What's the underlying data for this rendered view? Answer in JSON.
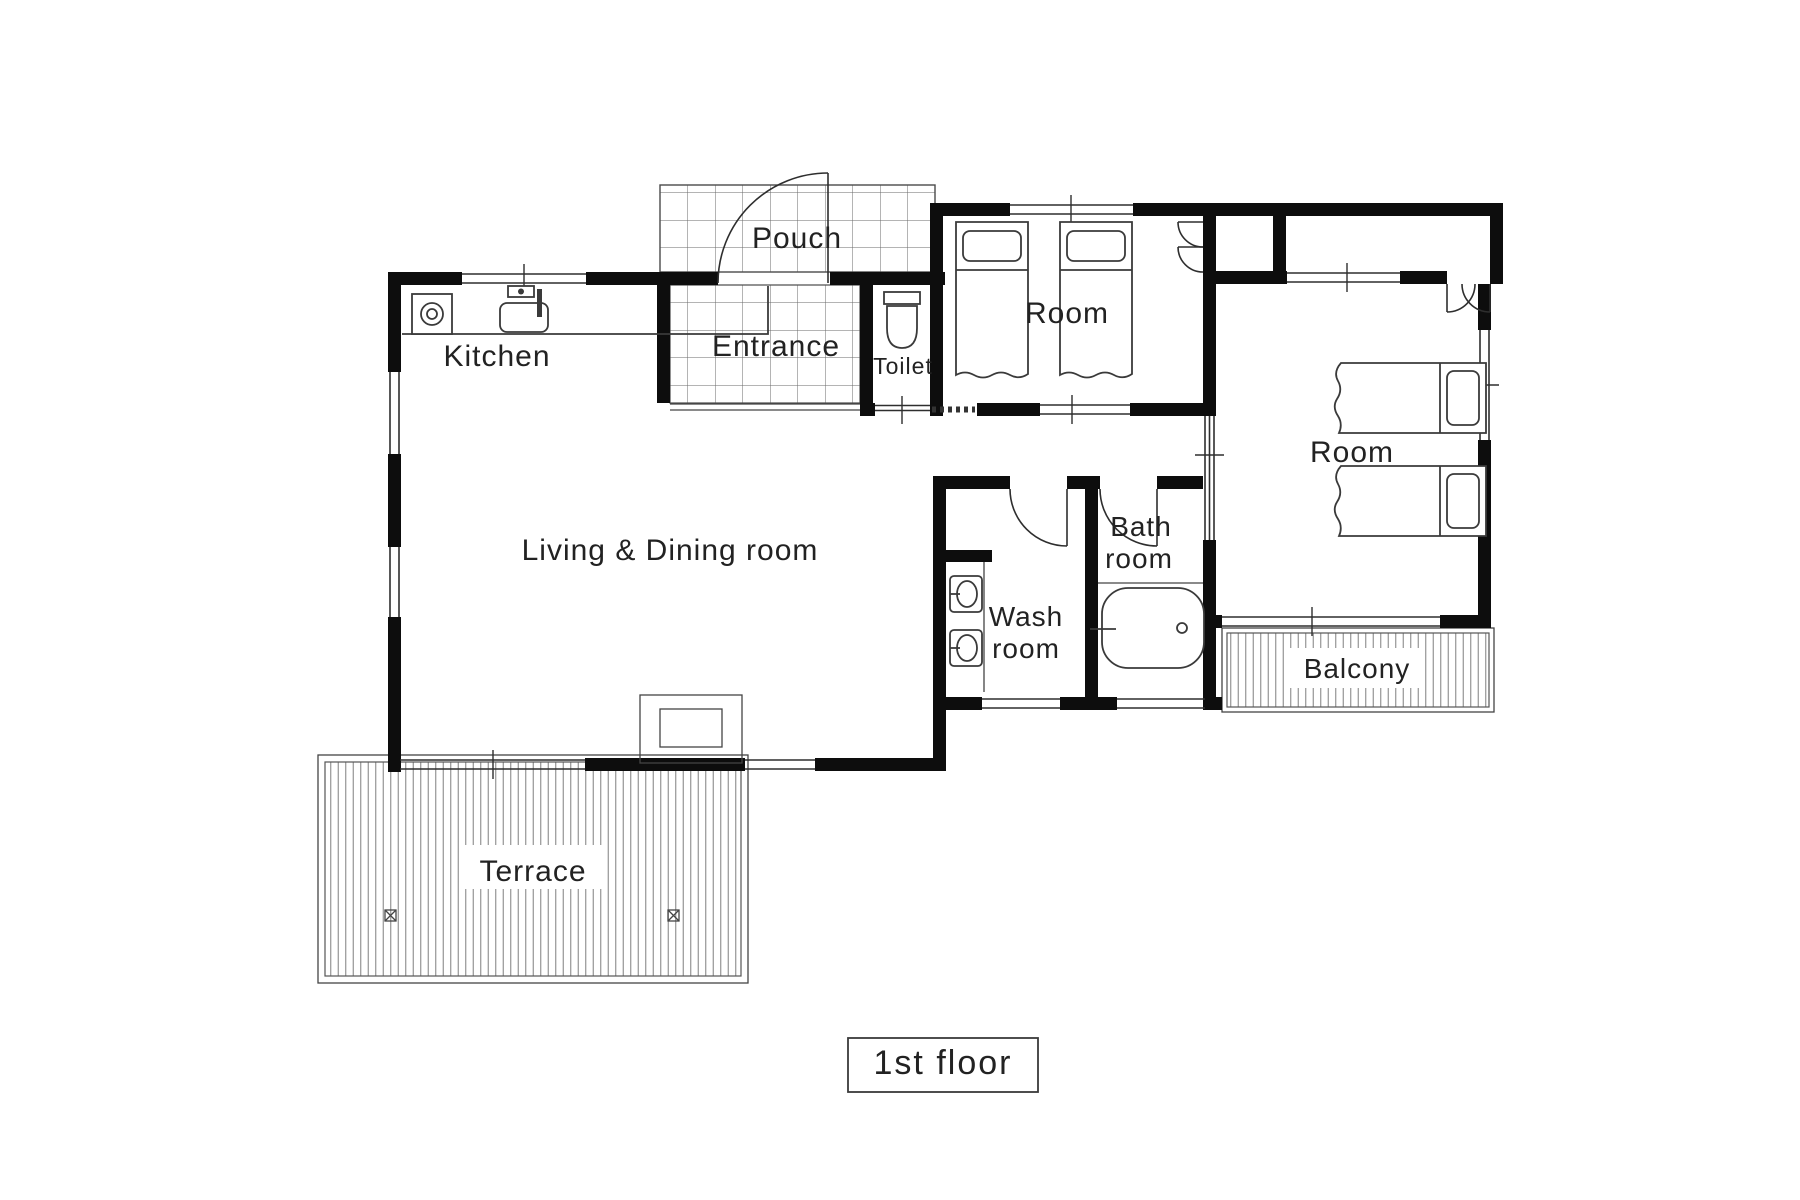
{
  "title_box": {
    "label": "1st floor"
  },
  "colors": {
    "wall": "#0d0d0d",
    "line": "#2e2e2e",
    "text": "#222222",
    "background": "#ffffff"
  },
  "rooms": {
    "pouch": {
      "label": "Pouch"
    },
    "entrance": {
      "label": "Entrance"
    },
    "toilet": {
      "label": "Toilet"
    },
    "bedroom_top": {
      "label": "Room"
    },
    "bedroom_right": {
      "label": "Room"
    },
    "kitchen": {
      "label": "Kitchen"
    },
    "living_dining": {
      "label": "Living & Dining room"
    },
    "wash_room": {
      "line1": "Wash",
      "line2": "room"
    },
    "bath_room": {
      "line1": "Bath",
      "line2": "room"
    },
    "balcony": {
      "label": "Balcony"
    },
    "terrace": {
      "label": "Terrace"
    }
  },
  "icons": {
    "stove": "stove-burner-icon",
    "sink": "kitchen-sink-icon",
    "toilet": "toilet-icon",
    "bathtub": "bathtub-icon",
    "washbasin": "wash-basin-icon",
    "bed": "single-bed-icon"
  }
}
